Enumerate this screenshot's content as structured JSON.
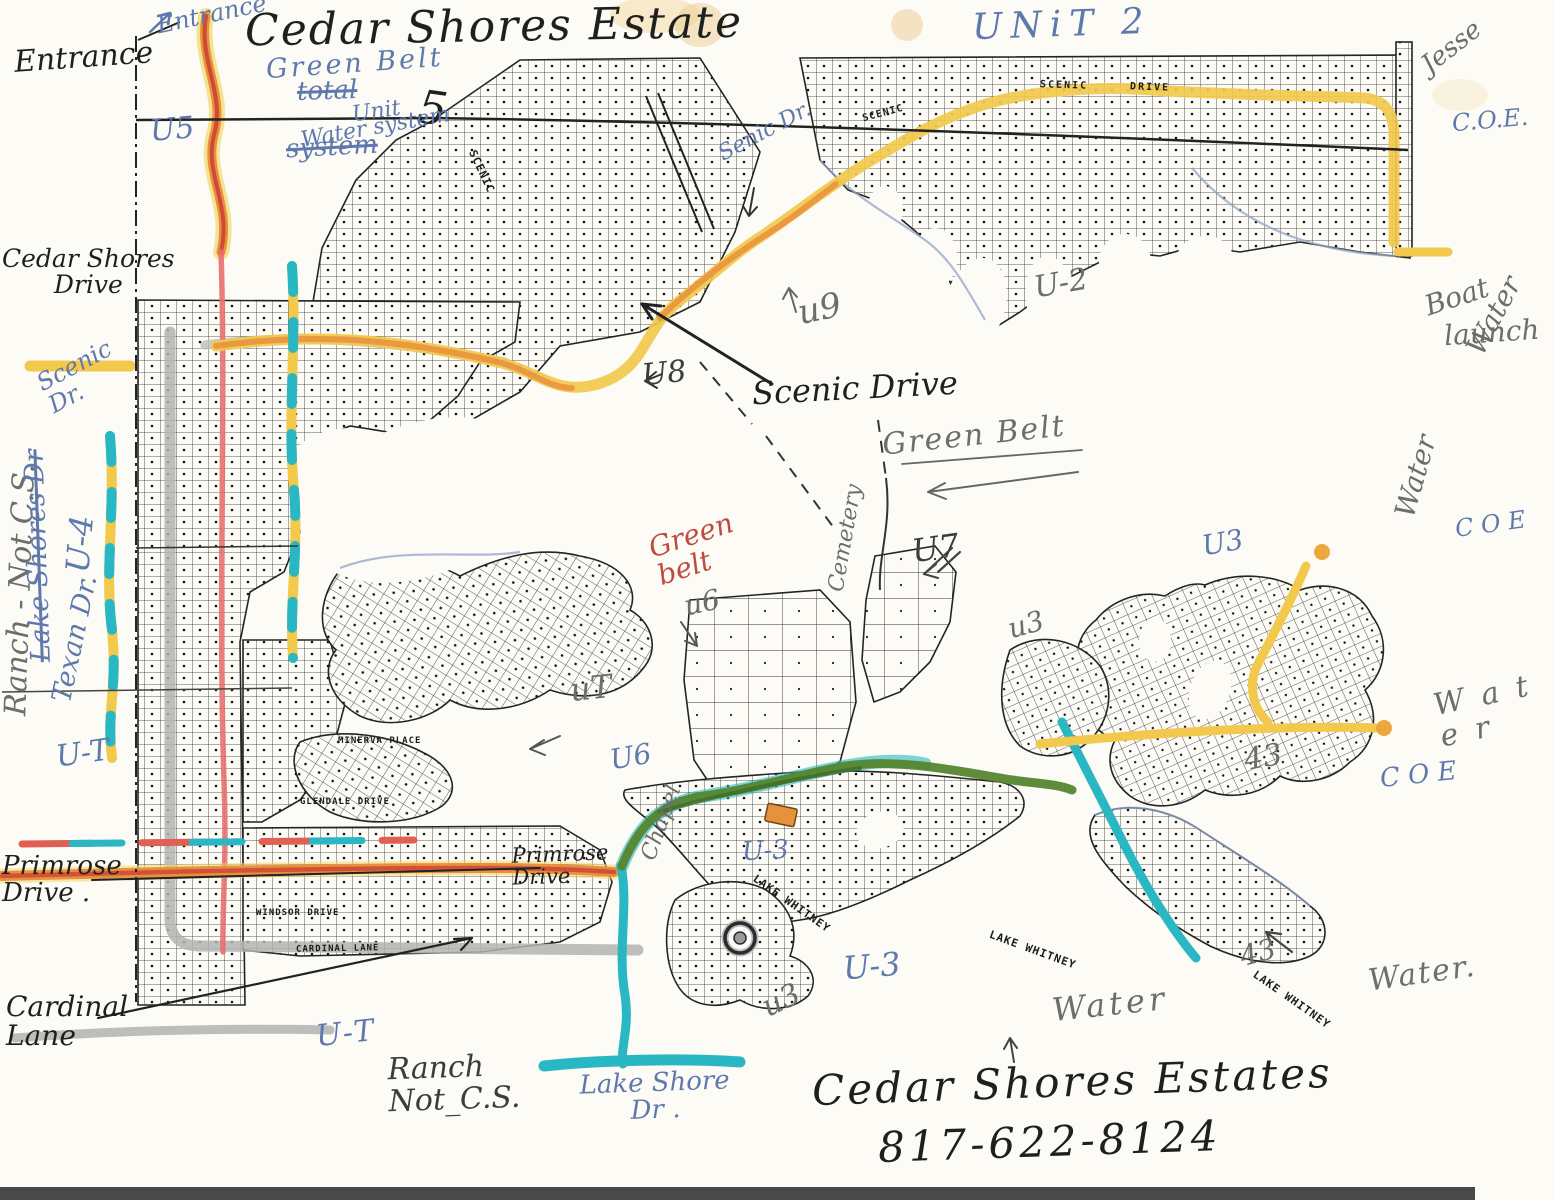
{
  "document": {
    "type": "hand-annotated subdivision plat map scan",
    "title": "Cedar Shores Estate",
    "phone": "817-622-8124"
  },
  "colors": {
    "paper": "#fcfbf6",
    "ink_black": "#1f1f1f",
    "ink_blue": "#5f79ad",
    "ink_pencil": "#6d6d6d",
    "ink_red": "#bf4a3e",
    "highlight_yellow": "#f2c94c",
    "highlight_orange": "#e8913c",
    "highlight_red": "#e06055",
    "highlight_green": "#55862f",
    "highlight_cyan": "#2ab7c4",
    "highlight_gray": "#b3b3b3"
  },
  "annotations": {
    "entrance_left": "Entrance",
    "entrance_top": "Entrance",
    "title": "Cedar Shores Estate",
    "unit2": "UNiT 2",
    "signature": "Jesse",
    "green_belt_blue": "Green Belt",
    "gb_total": "total",
    "gb_system": "system",
    "unit_word": "Unit",
    "unit5_num": "5",
    "water_system": "Water system",
    "u5": "U5",
    "coe1": "C.O.E.",
    "water_r1": "Water",
    "boat": "Boat",
    "launch": "launch",
    "water_r2": "Water",
    "coe2": "C O E",
    "u2": "U-2",
    "u9": "u9",
    "u8": "U8",
    "senic_dr": "Senic Dr.",
    "scenic_drive": "Scenic Drive",
    "green_belt_pencil": "Green Belt",
    "cemetery": "Cemetery",
    "green_belt_red": "Green\nbelt",
    "u7": "U7",
    "u6_small": "u6",
    "ut_pencil": "uT",
    "u6_blue": "U6",
    "chapel": "Chapel",
    "u3_blue_top": "U3",
    "u3_mid": "u3",
    "r43": "43",
    "water_wide": "W a t e r",
    "coe3": "C O E",
    "cedar_shores_drive": "Cedar Shores\nDrive",
    "scenic_dr_left": "Scenic\nDr.",
    "ranch_left": "Ranch - Not C.S.",
    "lakeshores_struck": "Lake Shores Dr",
    "u4_left": "U-4",
    "texan": "Texan Dr.",
    "ut_left": "U-T",
    "primrose_left": "Primrose\nDrive .",
    "cardinal": "Cardinal\nLane",
    "primrose_center": "Primrose\nDrive",
    "u3_blue_mid": "U-3",
    "u3_blue_bottom": "U-3",
    "u3_bottom_pc": "u3",
    "r43_bottom": "43",
    "water_bottom_mid": "Water",
    "water_bottom_right": "Water.",
    "ut_bottom": "U-T",
    "ranch_bottom": "Ranch\nNot_C.S.",
    "lakeshore_dr": "Lake Shore\nDr .",
    "estates_sig": "Cedar Shores Estates",
    "phone": "817-622-8124"
  },
  "map_labels": {
    "lake_whitney_1": "LAKE WHITNEY",
    "lake_whitney_2": "LAKE WHITNEY",
    "lake_whitney_3": "LAKE WHITNEY",
    "scenic_prt1": "SCENIC",
    "scenic_prt2": "DRIVE",
    "scenic_prt3": "SCENIC",
    "scenic_diag": "SCENIC",
    "minerva": "MINERVA PLACE",
    "glendale": "GLENDALE DRIVE",
    "windsor": "WINDSOR DRIVE",
    "cardinal_prt": "CARDINAL LANE"
  }
}
